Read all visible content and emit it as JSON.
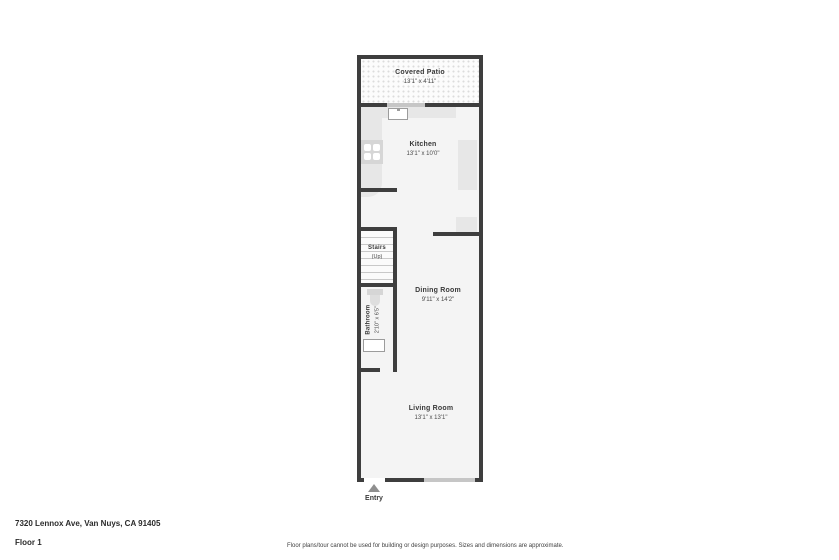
{
  "floorplan": {
    "covered_patio": {
      "name": "Covered Patio",
      "dims": "13'1\" x 4'11\""
    },
    "kitchen": {
      "name": "Kitchen",
      "dims": "13'1\" x 10'0\""
    },
    "stairs": {
      "name": "Stairs",
      "direction": "(Up)"
    },
    "bathroom": {
      "name": "Bathroom",
      "dims": "2'10\" x 6'5\""
    },
    "dining_room": {
      "name": "Dining Room",
      "dims": "9'11\" x 14'2\""
    },
    "living_room": {
      "name": "Living Room",
      "dims": "13'1\" x 13'1\""
    },
    "entry_label": "Entry"
  },
  "footer": {
    "address": "7320 Lennox Ave, Van Nuys, CA 91405",
    "floor_label": "Floor 1",
    "disclaimer": "Floor plans/tour cannot be used for building or design purposes. Sizes and dimensions are approximate."
  },
  "colors": {
    "wall": "#3e3e3e",
    "floor": "#f4f4f4",
    "counter": "#e7e7e7",
    "window": "#c6c6c6",
    "patio_dot": "#dcdcdc",
    "text": "#3a3a3a"
  }
}
